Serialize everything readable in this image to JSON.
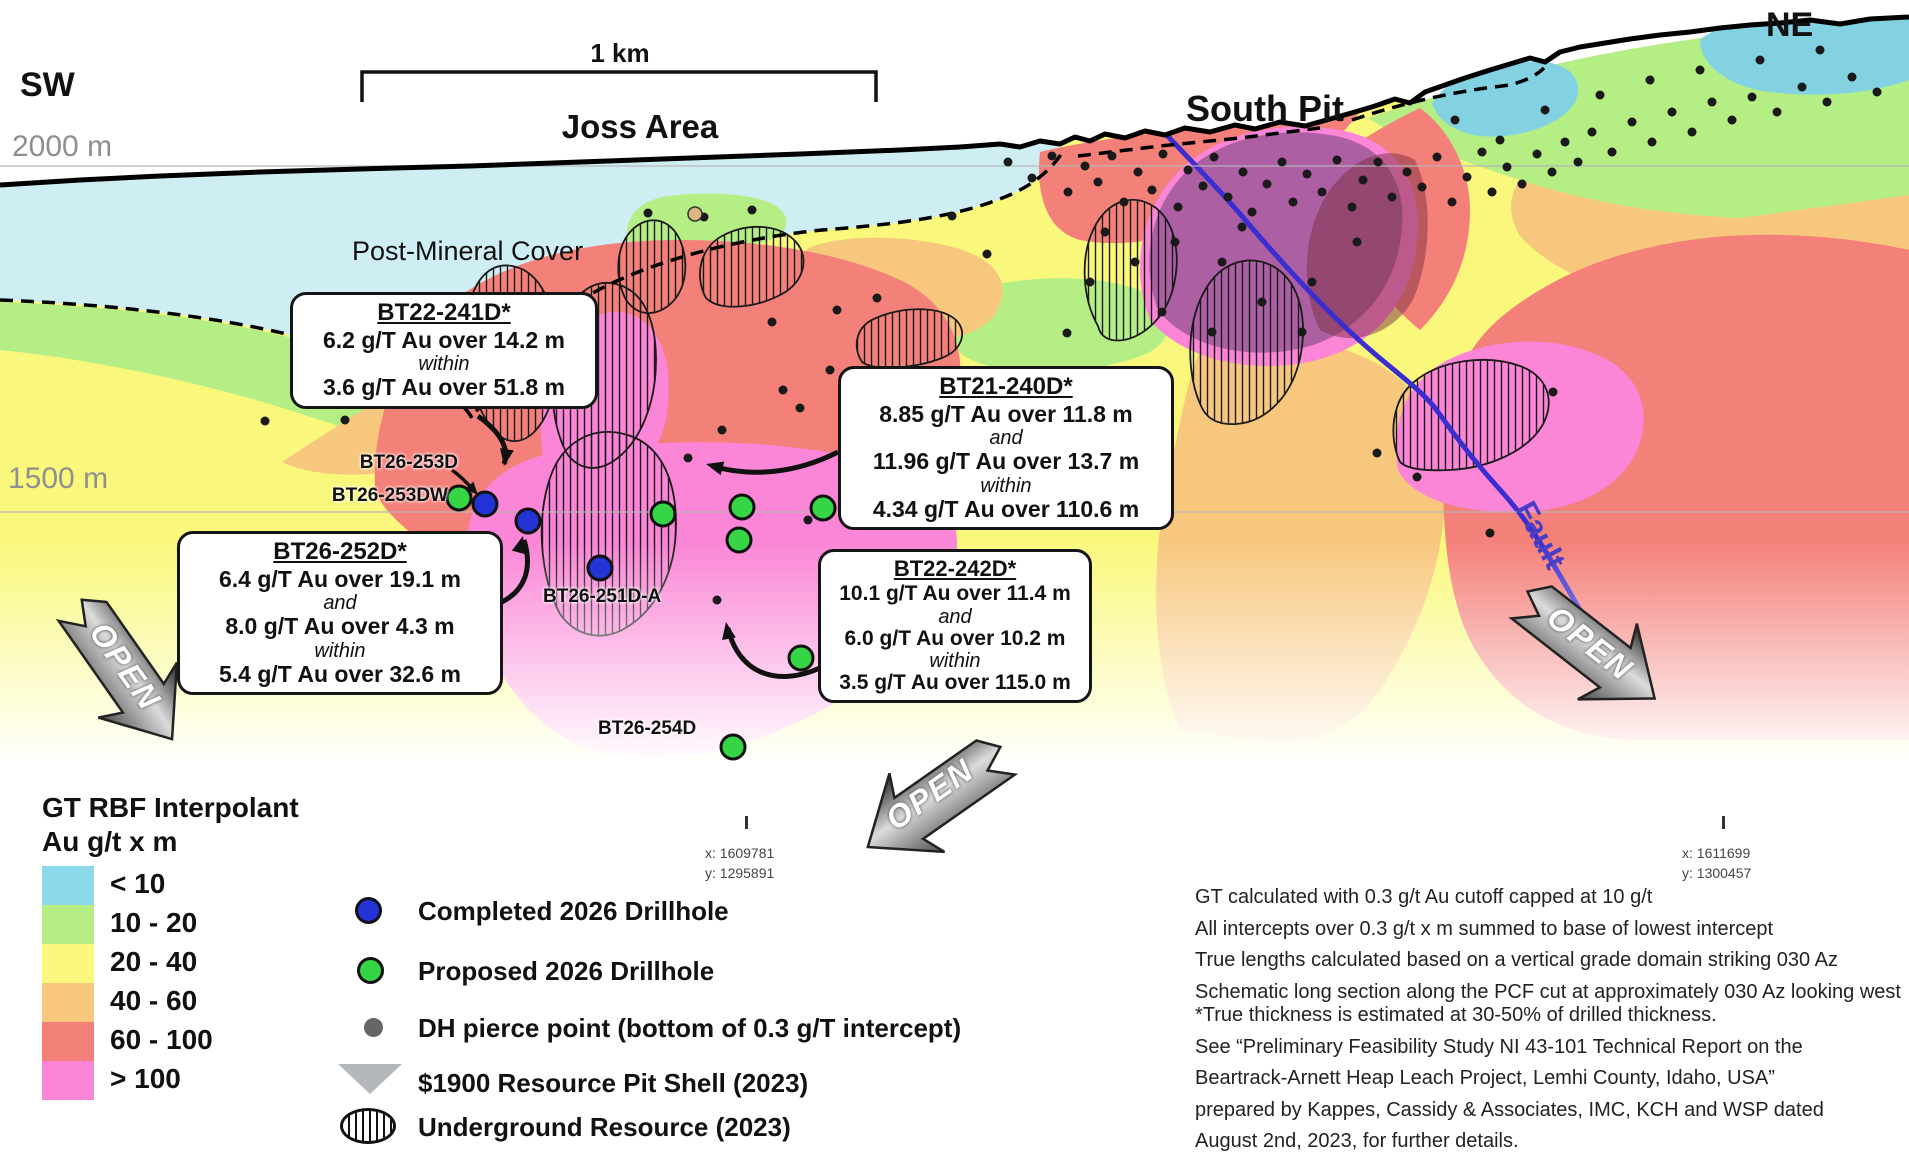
{
  "header": {
    "sw": "SW",
    "ne": "NE",
    "joss_area": "Joss Area",
    "south_pit": "South Pit",
    "post_mineral_cover": "Post-Mineral Cover",
    "scale_label": "1 km",
    "elev_upper": "2000 m",
    "elev_lower": "1500 m",
    "fault_label": "Fault",
    "open_label": "OPEN"
  },
  "callouts": {
    "bt22_241d": {
      "title": "BT22-241D*",
      "line1": "6.2 g/T Au over 14.2 m",
      "conn1": "within",
      "line2": "3.6 g/T Au over 51.8 m"
    },
    "bt26_252d": {
      "title": "BT26-252D*",
      "line1": "6.4 g/T Au over 19.1 m",
      "conn1": "and",
      "line2": "8.0 g/T Au over 4.3 m",
      "conn2": "within",
      "line3": "5.4 g/T Au over 32.6 m"
    },
    "bt21_240d": {
      "title": "BT21-240D*",
      "line1": "8.85 g/T Au over 11.8 m",
      "conn1": "and",
      "line2": "11.96 g/T Au over 13.7 m",
      "conn2": "within",
      "line3": "4.34 g/T Au over 110.6 m"
    },
    "bt22_242d": {
      "title": "BT22-242D*",
      "line1": "10.1 g/T Au over 11.4 m",
      "conn1": "and",
      "line2": "6.0 g/T Au over 10.2 m",
      "conn2": "within",
      "line3": "3.5 g/T Au over 115.0 m"
    }
  },
  "drillhole_labels": {
    "bt26_253d": "BT26-253D",
    "bt26_253dw": "BT26-253DW",
    "bt26_251d_a": "BT26-251D-A",
    "bt26_254d": "BT26-254D"
  },
  "coordinates": {
    "marker1": {
      "x": "x: 1609781",
      "y": "y: 1295891"
    },
    "marker2": {
      "x": "x: 1611699",
      "y": "y: 1300457"
    }
  },
  "legend": {
    "title_line1": "GT RBF Interpolant",
    "title_line2": "Au g/t x m",
    "classes": [
      {
        "label": "< 10",
        "color": "#8ad8e8"
      },
      {
        "label": "10 - 20",
        "color": "#b5ee85"
      },
      {
        "label": "20 - 40",
        "color": "#f9f87c"
      },
      {
        "label": "40 - 60",
        "color": "#f8c77e"
      },
      {
        "label": "60 - 100",
        "color": "#f4807a"
      },
      {
        "label": "> 100",
        "color": "#fb85d6"
      }
    ],
    "items": [
      {
        "icon": "completed-drillhole-icon",
        "label": "Completed 2026 Drillhole"
      },
      {
        "icon": "proposed-drillhole-icon",
        "label": "Proposed 2026 Drillhole"
      },
      {
        "icon": "pierce-point-icon",
        "label": "DH pierce point (bottom of 0.3 g/T intercept)"
      },
      {
        "icon": "pit-shell-icon",
        "label": "$1900 Resource Pit Shell (2023)"
      },
      {
        "icon": "underground-resource-icon",
        "label": "Underground Resource (2023)"
      }
    ]
  },
  "notes": {
    "block1": [
      "GT calculated with 0.3 g/t Au cutoff capped at 10 g/t",
      "All intercepts over 0.3 g/t x m summed to base of lowest intercept",
      "True lengths calculated based on a vertical grade domain striking 030 Az",
      "Schematic long section along the PCF cut at approximately 030 Az looking west"
    ],
    "block2": [
      "*True thickness is estimated at 30-50% of drilled thickness.",
      "See “Preliminary Feasibility Study NI 43-101 Technical Report on the",
      "Beartrack-Arnett Heap Leach Project, Lemhi County, Idaho, USA”",
      "prepared by Kappes, Cassidy & Associates, IMC, KCH and WSP dated",
      "August 2nd, 2023, for further details."
    ]
  },
  "map_points": {
    "colors": {
      "completed": "#2433d6",
      "proposed": "#35d546",
      "pierce": "#1a1a1a"
    },
    "completed_drillholes": [
      [
        485,
        504
      ],
      [
        528,
        521
      ],
      [
        600,
        568
      ]
    ],
    "proposed_drillholes": [
      [
        459,
        498
      ],
      [
        663,
        514
      ],
      [
        742,
        507
      ],
      [
        823,
        508
      ],
      [
        739,
        540
      ],
      [
        801,
        658
      ],
      [
        733,
        747
      ]
    ],
    "pierce_points": [
      [
        265,
        421
      ],
      [
        345,
        420
      ],
      [
        648,
        213
      ],
      [
        704,
        217
      ],
      [
        752,
        210
      ],
      [
        688,
        458
      ],
      [
        717,
        600
      ],
      [
        722,
        430
      ],
      [
        772,
        322
      ],
      [
        783,
        390
      ],
      [
        800,
        408
      ],
      [
        830,
        370
      ],
      [
        837,
        310
      ],
      [
        877,
        298
      ],
      [
        808,
        520
      ],
      [
        952,
        216
      ],
      [
        987,
        254
      ],
      [
        1067,
        333
      ],
      [
        1008,
        162
      ],
      [
        1032,
        178
      ],
      [
        1052,
        156
      ],
      [
        1068,
        192
      ],
      [
        1085,
        166
      ],
      [
        1098,
        182
      ],
      [
        1112,
        156
      ],
      [
        1124,
        202
      ],
      [
        1138,
        172
      ],
      [
        1152,
        190
      ],
      [
        1163,
        154
      ],
      [
        1178,
        207
      ],
      [
        1188,
        170
      ],
      [
        1203,
        186
      ],
      [
        1214,
        157
      ],
      [
        1228,
        197
      ],
      [
        1243,
        172
      ],
      [
        1252,
        212
      ],
      [
        1267,
        184
      ],
      [
        1282,
        162
      ],
      [
        1293,
        202
      ],
      [
        1307,
        174
      ],
      [
        1322,
        192
      ],
      [
        1337,
        160
      ],
      [
        1352,
        207
      ],
      [
        1363,
        180
      ],
      [
        1378,
        162
      ],
      [
        1392,
        197
      ],
      [
        1407,
        172
      ],
      [
        1422,
        187
      ],
      [
        1437,
        157
      ],
      [
        1452,
        202
      ],
      [
        1467,
        177
      ],
      [
        1482,
        152
      ],
      [
        1492,
        192
      ],
      [
        1507,
        167
      ],
      [
        1522,
        184
      ],
      [
        1537,
        154
      ],
      [
        1552,
        172
      ],
      [
        1565,
        142
      ],
      [
        1578,
        162
      ],
      [
        1592,
        132
      ],
      [
        1612,
        152
      ],
      [
        1632,
        122
      ],
      [
        1652,
        142
      ],
      [
        1672,
        112
      ],
      [
        1692,
        132
      ],
      [
        1712,
        102
      ],
      [
        1732,
        120
      ],
      [
        1752,
        97
      ],
      [
        1777,
        112
      ],
      [
        1802,
        87
      ],
      [
        1827,
        102
      ],
      [
        1852,
        77
      ],
      [
        1877,
        92
      ],
      [
        1105,
        232
      ],
      [
        1090,
        282
      ],
      [
        1135,
        262
      ],
      [
        1175,
        242
      ],
      [
        1222,
        262
      ],
      [
        1262,
        302
      ],
      [
        1162,
        312
      ],
      [
        1212,
        332
      ],
      [
        1312,
        282
      ],
      [
        1242,
        227
      ],
      [
        1357,
        242
      ],
      [
        1302,
        332
      ],
      [
        1377,
        453
      ],
      [
        1417,
        477
      ],
      [
        1490,
        533
      ],
      [
        1553,
        392
      ],
      [
        1455,
        120
      ],
      [
        1500,
        140
      ],
      [
        1545,
        110
      ],
      [
        1600,
        95
      ],
      [
        1650,
        80
      ],
      [
        1700,
        70
      ],
      [
        1760,
        60
      ],
      [
        1820,
        50
      ]
    ]
  }
}
